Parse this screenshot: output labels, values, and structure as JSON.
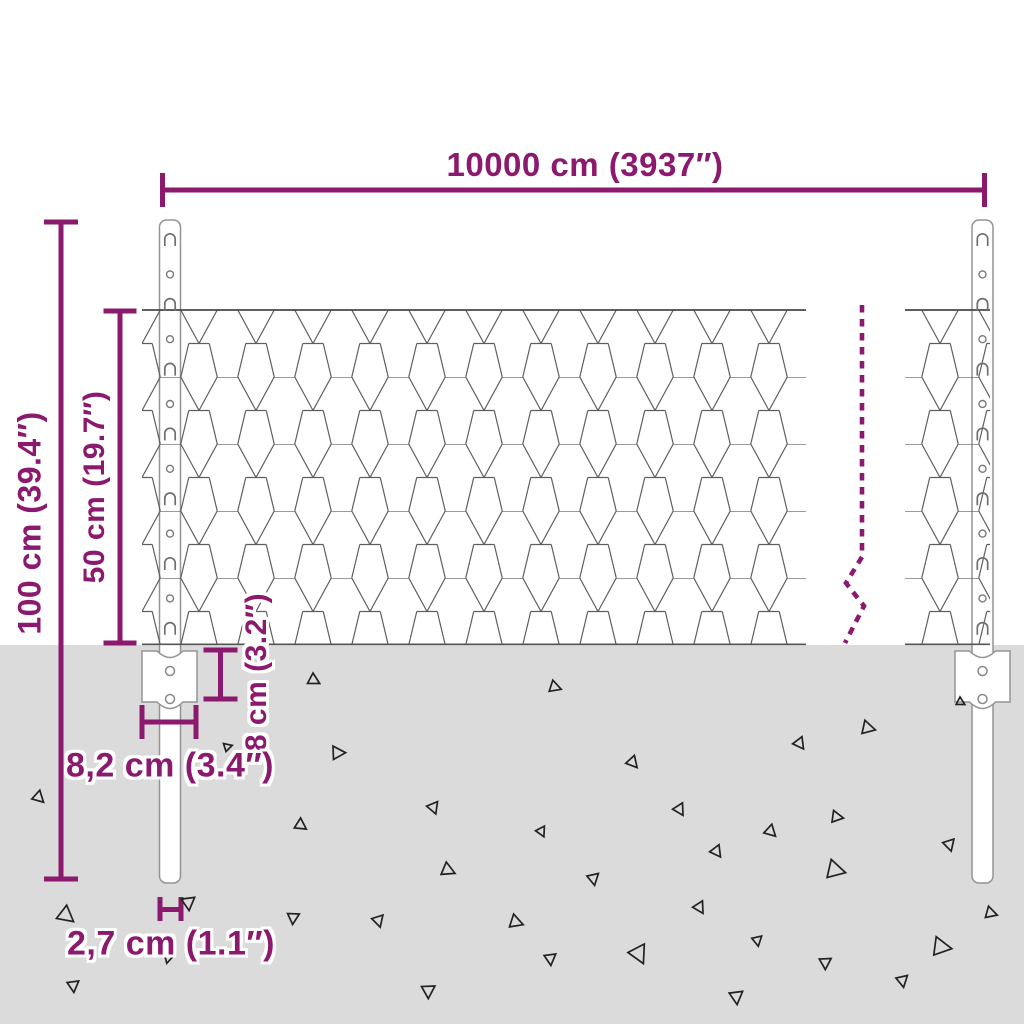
{
  "diagram": {
    "type": "product-dimension-diagram",
    "subject": "wire mesh fence with T-posts and ground anchor plates",
    "dimensions": {
      "total_width": "10000 cm (3937″)",
      "post_height": "100 cm (39.4″)",
      "mesh_height": "50 cm (19.7″)",
      "anchor_plate_depth": "8 cm (3.2″)",
      "anchor_plate_width": "8,2 cm (3.4″)",
      "post_thickness": "2,7 cm (1.1″)"
    },
    "colors": {
      "dimension_accent": "#8b1a6f",
      "ground": "#dbdbdb",
      "mesh_wire": "#5e5e5e",
      "post_outline": "#949494",
      "debris_outline": "#222222",
      "background": "#ffffff"
    }
  },
  "scene": {
    "ground_top_y": 645,
    "debris_triangles": [
      [
        313,
        680,
        7,
        0
      ],
      [
        554,
        687,
        7,
        10
      ],
      [
        960,
        702,
        5,
        0
      ],
      [
        867,
        728,
        8,
        15
      ],
      [
        799,
        743,
        7,
        -25
      ],
      [
        337,
        753,
        8,
        30
      ],
      [
        227,
        747,
        5,
        45
      ],
      [
        632,
        762,
        7,
        -20
      ],
      [
        38,
        797,
        7,
        -15
      ],
      [
        433,
        807,
        7,
        -40
      ],
      [
        300,
        825,
        7,
        -5
      ],
      [
        679,
        809,
        7,
        -30
      ],
      [
        541,
        831,
        6,
        -35
      ],
      [
        770,
        831,
        7,
        -15
      ],
      [
        836,
        817,
        7,
        20
      ],
      [
        949,
        844,
        7,
        -45
      ],
      [
        716,
        851,
        7,
        -25
      ],
      [
        447,
        870,
        8,
        5
      ],
      [
        593,
        878,
        7,
        -50
      ],
      [
        834,
        870,
        11,
        15
      ],
      [
        65,
        915,
        10,
        -10
      ],
      [
        188,
        902,
        8,
        -55
      ],
      [
        293,
        917,
        7,
        -65
      ],
      [
        378,
        920,
        7,
        -45
      ],
      [
        699,
        907,
        7,
        -30
      ],
      [
        515,
        922,
        8,
        10
      ],
      [
        990,
        913,
        7,
        12
      ],
      [
        757,
        940,
        6,
        -50
      ],
      [
        168,
        958,
        5,
        -75
      ],
      [
        550,
        958,
        7,
        -55
      ],
      [
        638,
        953,
        11,
        -35
      ],
      [
        825,
        962,
        7,
        -60
      ],
      [
        940,
        947,
        11,
        20
      ],
      [
        902,
        980,
        7,
        -50
      ],
      [
        73,
        985,
        7,
        -55
      ],
      [
        428,
        990,
        8,
        -60
      ],
      [
        736,
        996,
        8,
        -55
      ]
    ],
    "posts": [
      {
        "cx": 170
      },
      {
        "cx": 982.5
      }
    ],
    "post_features": {
      "start_y": 238,
      "spacing": 32.4,
      "count": 13
    }
  }
}
